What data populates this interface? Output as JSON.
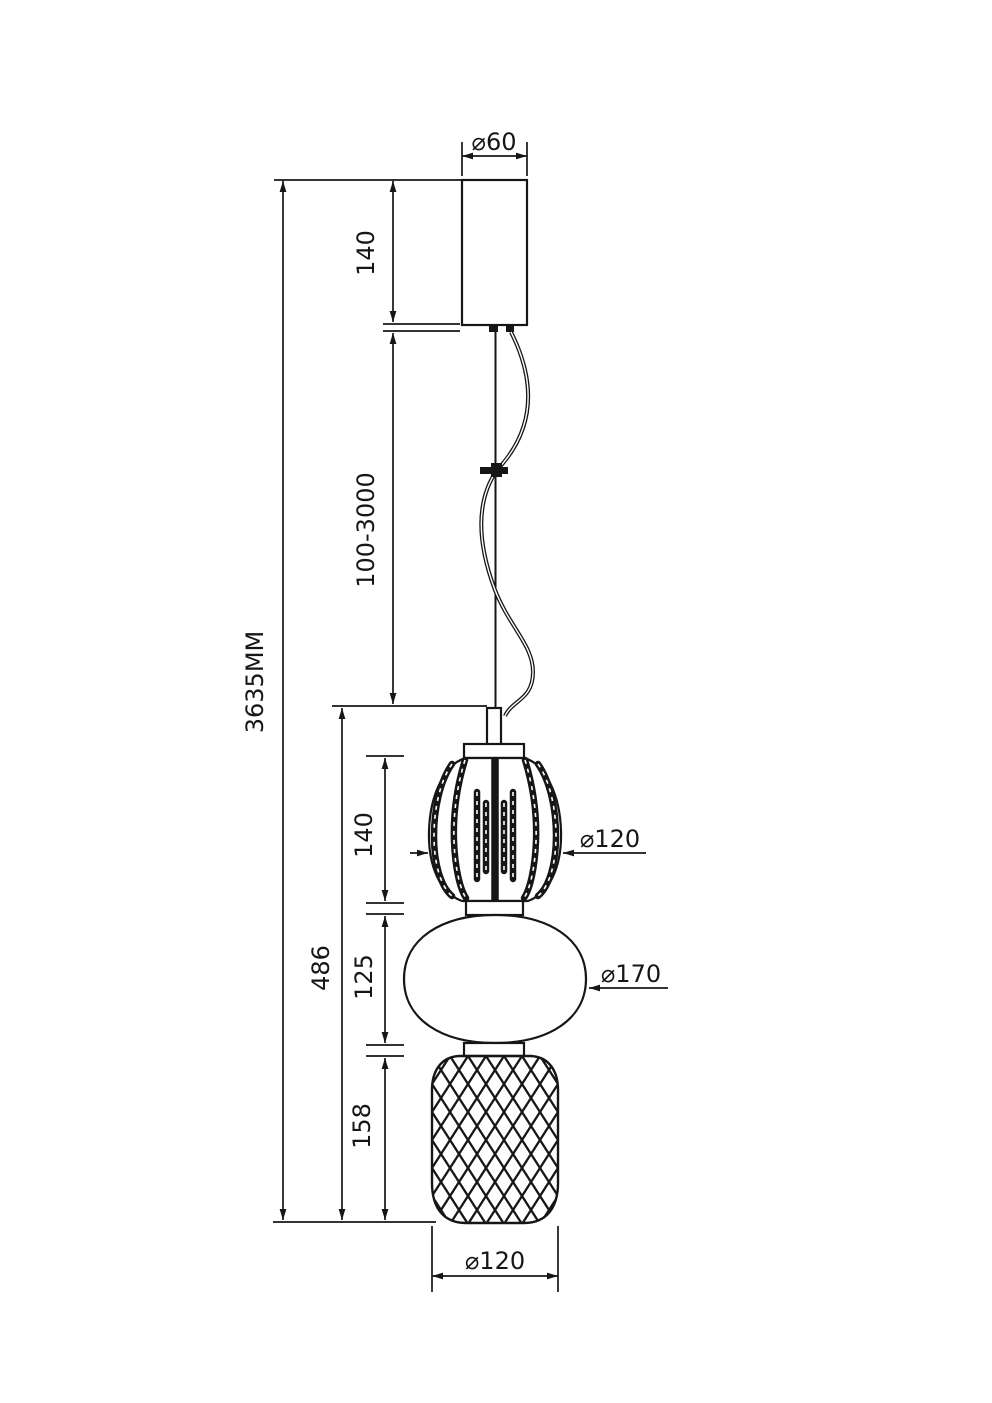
{
  "diagram": {
    "type": "technical-dimension-drawing",
    "subject": "pendant-lamp-elevation",
    "colors": {
      "background": "#ffffff",
      "line": "#161616"
    },
    "labels": {
      "canopy_diameter": "⌀60",
      "canopy_height": "140",
      "suspension_length": "100-3000",
      "total_height": "3635MM",
      "body_height": "486",
      "top_shade_height": "140",
      "top_shade_diameter": "⌀120",
      "middle_shade_height": "125",
      "middle_shade_diameter": "⌀170",
      "bottom_shade_height": "158",
      "bottom_shade_diameter": "⌀120"
    }
  }
}
